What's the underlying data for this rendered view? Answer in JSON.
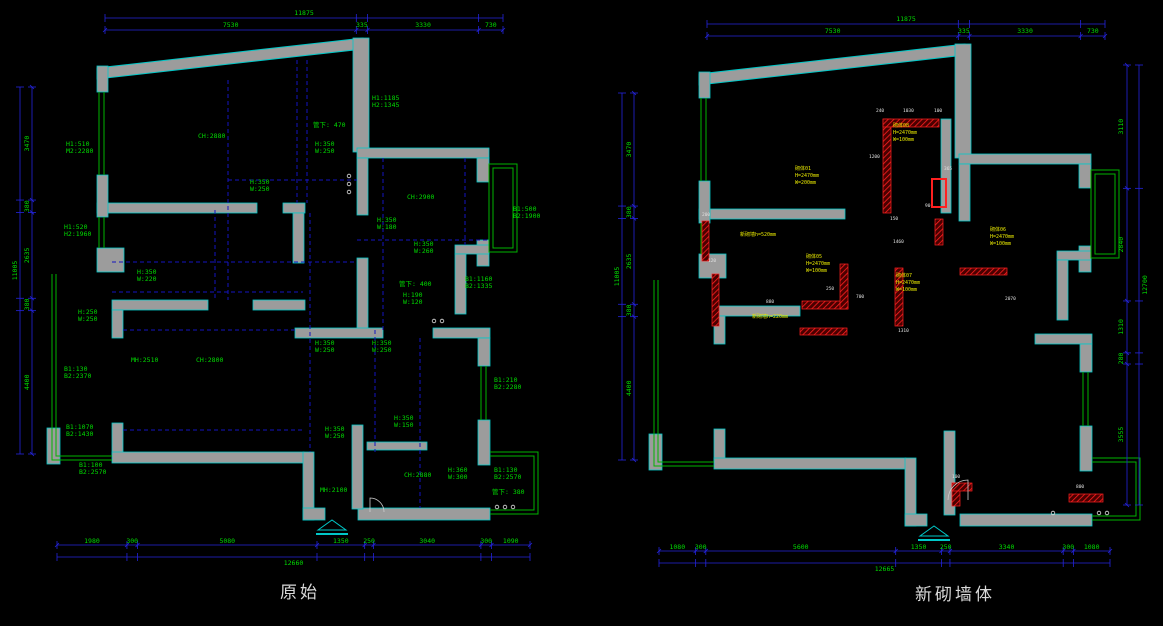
{
  "titles": {
    "left": "原始",
    "right": "新砌墙体"
  },
  "colors": {
    "background": "#000000",
    "wall_gray": "#9c9c9c",
    "wall_outline_cyan": "#00c8c8",
    "window_green": "#00b400",
    "dimension_blue": "#2424dc",
    "text_green": "#00dc00",
    "new_wall_red": "#ff2020",
    "label_yellow": "#e8e800",
    "tag_white": "#e0e0e0"
  },
  "plans": {
    "left": {
      "title": "原始",
      "dims": {
        "top": {
          "total": "11875",
          "segments": [
            "7530",
            "335",
            "3330",
            "730"
          ]
        },
        "side": {
          "total": "11005",
          "segments": [
            "3470",
            "380",
            "2635",
            "380",
            "4400"
          ]
        },
        "bottom": {
          "total": "12660",
          "segments": [
            "1980",
            "300",
            "5080",
            "1350",
            "250",
            "3040",
            "300",
            "1090"
          ]
        }
      },
      "labels": [
        {
          "t": "H1:1185\nH2:1345",
          "x": 372,
          "y": 100
        },
        {
          "t": "管下: 470",
          "x": 313,
          "y": 127
        },
        {
          "t": "H:350\nW:250",
          "x": 315,
          "y": 146
        },
        {
          "t": "CH:2880",
          "x": 198,
          "y": 138
        },
        {
          "t": "H1:510\nM2:2280",
          "x": 66,
          "y": 146
        },
        {
          "t": "H1:520\nH2:1960",
          "x": 64,
          "y": 229
        },
        {
          "t": "H:350\nW:220",
          "x": 137,
          "y": 274
        },
        {
          "t": "H:250\nW:250",
          "x": 78,
          "y": 314
        },
        {
          "t": "H:350\nW:250",
          "x": 250,
          "y": 184
        },
        {
          "t": "B1:130\nB2:2370",
          "x": 64,
          "y": 371
        },
        {
          "t": "MH:2510",
          "x": 131,
          "y": 362
        },
        {
          "t": "CH:2800",
          "x": 196,
          "y": 362
        },
        {
          "t": "B1:1070\nB2:1430",
          "x": 66,
          "y": 429
        },
        {
          "t": "B1:100\nB2:2570",
          "x": 79,
          "y": 467
        },
        {
          "t": "H:350\nW:250",
          "x": 315,
          "y": 345
        },
        {
          "t": "H:350\nW:250",
          "x": 372,
          "y": 345
        },
        {
          "t": "H:350\nW:150",
          "x": 394,
          "y": 420
        },
        {
          "t": "H:350\nW:250",
          "x": 325,
          "y": 431
        },
        {
          "t": "B1:210\nB2:2280",
          "x": 494,
          "y": 382
        },
        {
          "t": "CH:2880",
          "x": 404,
          "y": 477
        },
        {
          "t": "H:360\nW:300",
          "x": 448,
          "y": 472
        },
        {
          "t": "B1:130\nB2:2570",
          "x": 494,
          "y": 472
        },
        {
          "t": "管下: 380",
          "x": 492,
          "y": 494
        },
        {
          "t": "MH:2100",
          "x": 320,
          "y": 492
        },
        {
          "t": "CH:2900",
          "x": 407,
          "y": 199
        },
        {
          "t": "H:350\nW:180",
          "x": 377,
          "y": 222
        },
        {
          "t": "H:350\nW:260",
          "x": 414,
          "y": 246
        },
        {
          "t": "管下: 400",
          "x": 399,
          "y": 286
        },
        {
          "t": "H:190\nW:120",
          "x": 403,
          "y": 297
        },
        {
          "t": "B1:500\nB2:1900",
          "x": 513,
          "y": 211
        },
        {
          "t": "B1:1160\nB2:1335",
          "x": 465,
          "y": 281
        }
      ]
    },
    "right": {
      "title": "新砌墙体",
      "dims": {
        "top": {
          "total": "11875",
          "segments": [
            "7530",
            "335",
            "3330",
            "730"
          ]
        },
        "side": {
          "total": "11005",
          "segments": [
            "3470",
            "380",
            "2635",
            "380",
            "4400"
          ]
        },
        "right_side": {
          "total": "12700",
          "segments": [
            "3110",
            "2840",
            "1310",
            "280",
            "3555"
          ]
        },
        "bottom": {
          "total": "12665",
          "segments": [
            "1080",
            "300",
            "5600",
            "1350",
            "250",
            "3340",
            "300",
            "1080"
          ]
        }
      },
      "labels": [
        {
          "t": "砌体08\nH=2470mm\nW=100mm",
          "x": 893,
          "y": 127,
          "c": "y"
        },
        {
          "t": "砌体01\nH=2470mm\nW=200mm",
          "x": 795,
          "y": 170,
          "c": "y"
        },
        {
          "t": "新砌墙h=520mm",
          "x": 740,
          "y": 236,
          "c": "y"
        },
        {
          "t": "砌体05\nH=2470mm\nW=100mm",
          "x": 806,
          "y": 258,
          "c": "y"
        },
        {
          "t": "新砌墙h=220mm",
          "x": 752,
          "y": 318,
          "c": "y"
        },
        {
          "t": "砌体06\nH=2470mm\nW=100mm",
          "x": 990,
          "y": 231,
          "c": "y"
        },
        {
          "t": "砌体07\nH=2470mm\nW=100mm",
          "x": 896,
          "y": 277,
          "c": "y"
        },
        {
          "t": "240",
          "x": 876,
          "y": 112,
          "c": "w"
        },
        {
          "t": "1030",
          "x": 903,
          "y": 112,
          "c": "w"
        },
        {
          "t": "100",
          "x": 934,
          "y": 112,
          "c": "w"
        },
        {
          "t": "1200",
          "x": 869,
          "y": 158,
          "c": "w"
        },
        {
          "t": "365",
          "x": 944,
          "y": 170,
          "c": "w"
        },
        {
          "t": "90",
          "x": 925,
          "y": 207,
          "c": "w"
        },
        {
          "t": "150",
          "x": 890,
          "y": 220,
          "c": "w"
        },
        {
          "t": "1460",
          "x": 893,
          "y": 243,
          "c": "w"
        },
        {
          "t": "700",
          "x": 856,
          "y": 298,
          "c": "w"
        },
        {
          "t": "250",
          "x": 826,
          "y": 290,
          "c": "w"
        },
        {
          "t": "880",
          "x": 766,
          "y": 303,
          "c": "w"
        },
        {
          "t": "120",
          "x": 708,
          "y": 262,
          "c": "w"
        },
        {
          "t": "200",
          "x": 702,
          "y": 216,
          "c": "w"
        },
        {
          "t": "1310",
          "x": 898,
          "y": 332,
          "c": "w"
        },
        {
          "t": "2070",
          "x": 1005,
          "y": 300,
          "c": "w"
        },
        {
          "t": "800",
          "x": 1076,
          "y": 488,
          "c": "w"
        },
        {
          "t": "100",
          "x": 952,
          "y": 478,
          "c": "w"
        }
      ]
    }
  }
}
